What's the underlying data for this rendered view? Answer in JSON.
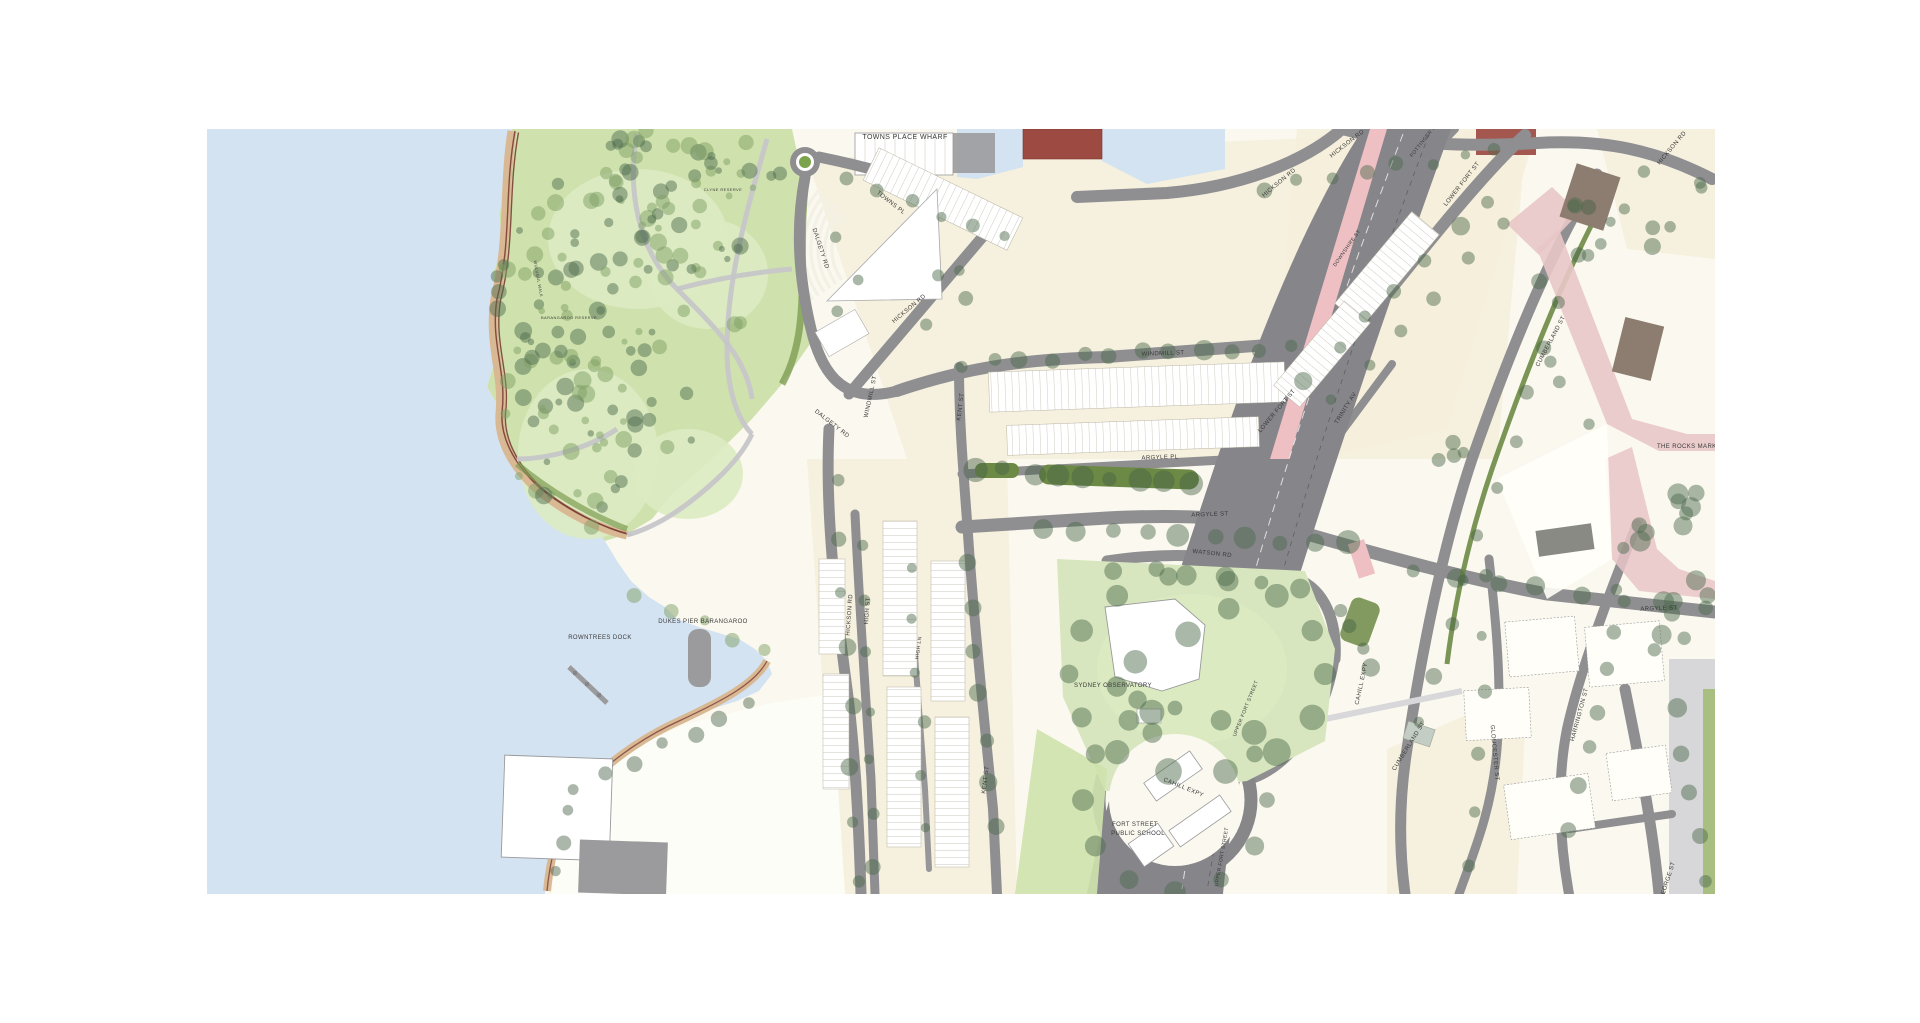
{
  "map": {
    "colors": {
      "water": "#d4e3f1",
      "land": "#fbf9ef",
      "block_cream": "#f4efdb",
      "park_green": "#cfe2ad",
      "lawn_light": "#dcebc2",
      "observatory_green": "#d8e6bf",
      "road_gray": "#8f8f92",
      "highway_gray": "#85858a",
      "overpass_pink": "#eec0c3",
      "rocks_pink": "#e9c6c8",
      "sand_tan": "#d9b894",
      "path_red": "#7a3f35",
      "median_green": "#6c8a45",
      "building_white": "#ffffff",
      "building_gray": "#9b9b9d",
      "building_maroon": "#9c4a42",
      "building_brown": "#8d7d70",
      "footpath_gray": "#d7d7d9",
      "label_color": "#3a3a3a"
    },
    "labels": [
      {
        "text": "TOWNS PLACE WHARF",
        "x": 698,
        "y": 10,
        "rot": 0,
        "size": 7
      },
      {
        "text": "TOWNS PL",
        "x": 683,
        "y": 75,
        "rot": 38,
        "size": 6
      },
      {
        "text": "DALGETY RD",
        "x": 612,
        "y": 120,
        "rot": 72,
        "size": 6
      },
      {
        "text": "DALGETY RD",
        "x": 624,
        "y": 296,
        "rot": 38,
        "size": 6
      },
      {
        "text": "HICKSON RD",
        "x": 703,
        "y": 181,
        "rot": -40,
        "size": 6
      },
      {
        "text": "WINDMILL ST",
        "x": 665,
        "y": 268,
        "rot": -78,
        "size": 6
      },
      {
        "text": "WINDMILL ST",
        "x": 956,
        "y": 226,
        "rot": -2,
        "size": 6
      },
      {
        "text": "KENT ST",
        "x": 755,
        "y": 278,
        "rot": -83,
        "size": 6
      },
      {
        "text": "KENT ST",
        "x": 780,
        "y": 651,
        "rot": -83,
        "size": 6
      },
      {
        "text": "LOWER FORT ST",
        "x": 1256,
        "y": 56,
        "rot": -52,
        "size": 6
      },
      {
        "text": "LOWER FORT ST",
        "x": 1071,
        "y": 283,
        "rot": -50,
        "size": 6
      },
      {
        "text": "TRINITY AV",
        "x": 1140,
        "y": 280,
        "rot": -58,
        "size": 6
      },
      {
        "text": "ARGYLE PL",
        "x": 953,
        "y": 330,
        "rot": -2,
        "size": 6
      },
      {
        "text": "ARGYLE ST",
        "x": 1003,
        "y": 387,
        "rot": -2,
        "size": 6
      },
      {
        "text": "ARGYLE ST",
        "x": 1452,
        "y": 481,
        "rot": -2,
        "size": 6
      },
      {
        "text": "WATSON RD",
        "x": 1005,
        "y": 426,
        "rot": 6,
        "size": 6
      },
      {
        "text": "THE ROCKS MARKET",
        "x": 1484,
        "y": 319,
        "rot": 0,
        "size": 6
      },
      {
        "text": "CUMBERLAND ST",
        "x": 1345,
        "y": 213,
        "rot": -62,
        "size": 6
      },
      {
        "text": "CUMBERLAND ST",
        "x": 1203,
        "y": 618,
        "rot": -58,
        "size": 6
      },
      {
        "text": "GLOUCESTER ST",
        "x": 1286,
        "y": 624,
        "rot": 85,
        "size": 6
      },
      {
        "text": "HARRINGTON ST",
        "x": 1374,
        "y": 586,
        "rot": -75,
        "size": 6
      },
      {
        "text": "CAHILL EXPY",
        "x": 1156,
        "y": 555,
        "rot": -78,
        "size": 6
      },
      {
        "text": "CAHILL EXPY",
        "x": 976,
        "y": 660,
        "rot": 22,
        "size": 6
      },
      {
        "text": "UPPER FORT STREET",
        "x": 1040,
        "y": 580,
        "rot": -68,
        "size": 5
      },
      {
        "text": "UPPER FORT STREET",
        "x": 1016,
        "y": 728,
        "rot": -80,
        "size": 5
      },
      {
        "text": "SYDNEY OBSERVATORY",
        "x": 906,
        "y": 558,
        "rot": 0,
        "size": 6
      },
      {
        "text": "FORT STREET",
        "x": 928,
        "y": 697,
        "rot": 0,
        "size": 6
      },
      {
        "text": "PUBLIC SCHOOL",
        "x": 931,
        "y": 706,
        "rot": 0,
        "size": 6
      },
      {
        "text": "ROWNTREES DOCK",
        "x": 393,
        "y": 510,
        "rot": 0,
        "size": 6
      },
      {
        "text": "DUKES PIER BARANGAROO",
        "x": 496,
        "y": 494,
        "rot": 0,
        "size": 6
      },
      {
        "text": "HICKSON RD",
        "x": 644,
        "y": 486,
        "rot": -86,
        "size": 6
      },
      {
        "text": "HIGH ST",
        "x": 662,
        "y": 482,
        "rot": -86,
        "size": 6
      },
      {
        "text": "HIGH LN",
        "x": 713,
        "y": 519,
        "rot": -82,
        "size": 5
      },
      {
        "text": "HICKSON RD",
        "x": 1073,
        "y": 55,
        "rot": -40,
        "size": 6
      },
      {
        "text": "HICKSON RD",
        "x": 1141,
        "y": 16,
        "rot": -38,
        "size": 6
      },
      {
        "text": "HICKSON RD",
        "x": 1466,
        "y": 20,
        "rot": -50,
        "size": 6
      },
      {
        "text": "POTTINGER ST",
        "x": 1218,
        "y": 12,
        "rot": -52,
        "size": 5
      },
      {
        "text": "DOWNSHIRE ST",
        "x": 1141,
        "y": 120,
        "rot": -55,
        "size": 5
      },
      {
        "text": "GEORGE ST",
        "x": 1462,
        "y": 752,
        "rot": -72,
        "size": 6
      },
      {
        "text": "CLYNE RESERVE",
        "x": 516,
        "y": 62,
        "rot": 0,
        "size": 4
      },
      {
        "text": "BARANGAROO RESERVE",
        "x": 362,
        "y": 190,
        "rot": 0,
        "size": 4
      },
      {
        "text": "WULUGUL WALK",
        "x": 330,
        "y": 150,
        "rot": 80,
        "size": 4
      }
    ]
  }
}
